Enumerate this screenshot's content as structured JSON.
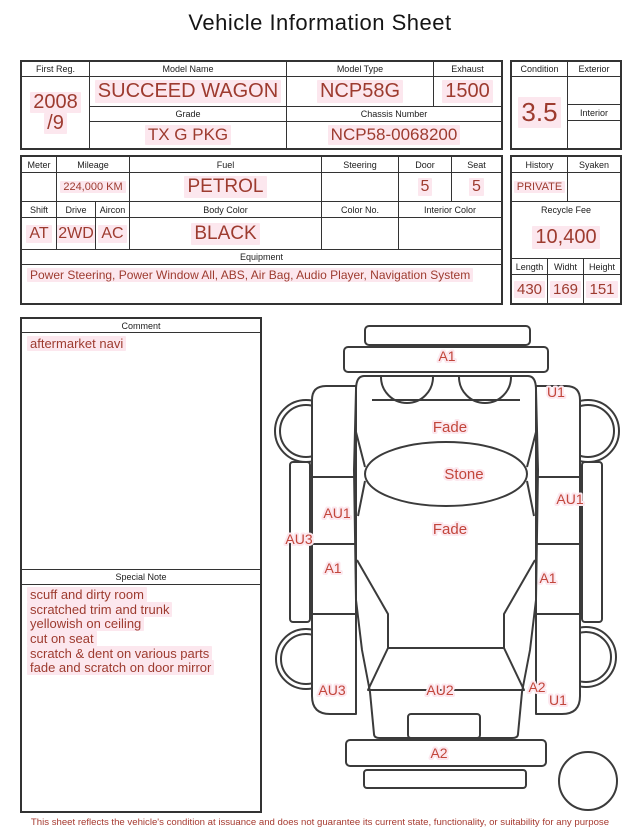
{
  "title": "Vehicle Information Sheet",
  "top_table": {
    "first_reg_label": "First Reg.",
    "first_reg_year": "2008",
    "first_reg_month": "/9",
    "model_name_label": "Model Name",
    "model_name": "SUCCEED WAGON",
    "model_type_label": "Model Type",
    "model_type": "NCP58G",
    "exhaust_label": "Exhaust",
    "exhaust": "1500",
    "grade_label": "Grade",
    "grade": "TX G PKG",
    "chassis_number_label": "Chassis Number",
    "chassis_number": "NCP58-0068200"
  },
  "condition_panel": {
    "condition_label": "Condition",
    "condition_value": "3.5",
    "exterior_label": "Exterior",
    "exterior_value": "",
    "interior_label": "Interior",
    "interior_value": ""
  },
  "spec_table": {
    "meter_label": "Meter",
    "meter_value": "",
    "mileage_label": "Mileage",
    "mileage": "224,000 KM",
    "fuel_label": "Fuel",
    "fuel": "PETROL",
    "steering_label": "Steering",
    "steering_value": "",
    "door_label": "Door",
    "door": "5",
    "seat_label": "Seat",
    "seat": "5",
    "shift_label": "Shift",
    "shift": "AT",
    "drive_label": "Drive",
    "drive": "2WD",
    "aircon_label": "Aircon",
    "aircon": "AC",
    "body_color_label": "Body Color",
    "body_color": "BLACK",
    "color_no_label": "Color No.",
    "color_no_value": "",
    "interior_color_label": "Interior Color",
    "interior_color_value": "",
    "equipment_label": "Equipment",
    "equipment": "Power Steering, Power Window  All, ABS, Air Bag, Audio Player, Navigation System"
  },
  "history_panel": {
    "history_label": "History",
    "history": "PRIVATE",
    "syaken_label": "Syaken",
    "syaken_value": "",
    "recycle_fee_label": "Recycle Fee",
    "recycle_fee": "10,400",
    "length_label": "Length",
    "length": "430",
    "width_label": "Widht",
    "width": "169",
    "height_label": "Height",
    "height": "151"
  },
  "comment": {
    "label": "Comment",
    "text": "aftermarket navi"
  },
  "special_note": {
    "label": "Special Note",
    "lines": [
      "scuff and dirty room",
      "scratched trim and trunk",
      "yellowish on ceiling",
      "cut on seat",
      "scratch & dent on various parts",
      "fade and scratch on door mirror"
    ]
  },
  "diagram": {
    "labels": [
      {
        "area": "front-bumper",
        "text": "A1"
      },
      {
        "area": "front-right-fender",
        "text": "U1"
      },
      {
        "area": "hood",
        "text": "Fade"
      },
      {
        "area": "windshield",
        "text": "Stone"
      },
      {
        "area": "right-front-door",
        "text": "AU1"
      },
      {
        "area": "left-front-door",
        "text": "AU1"
      },
      {
        "area": "left-sill",
        "text": "AU3"
      },
      {
        "area": "roof",
        "text": "Fade"
      },
      {
        "area": "left-rear-door",
        "text": "A1"
      },
      {
        "area": "right-rear-door",
        "text": "A1"
      },
      {
        "area": "left-rear-fender",
        "text": "AU3"
      },
      {
        "area": "tailgate",
        "text": "AU2"
      },
      {
        "area": "right-rear-fender",
        "text": "A2"
      },
      {
        "area": "right-rear-fender-2",
        "text": "U1"
      },
      {
        "area": "rear-bumper",
        "text": "A2"
      }
    ]
  },
  "footer": {
    "disclaimer": "This sheet reflects the vehicle's condition at issuance and does not guarantee its current state, functionality, or suitability for any purpose"
  },
  "colors": {
    "value_red": "#9d3b2f",
    "diagram_red": "#c2463b",
    "highlight_pink": "#fce7ee",
    "line_dark": "#333333",
    "disclaimer_red": "#a63a30"
  }
}
